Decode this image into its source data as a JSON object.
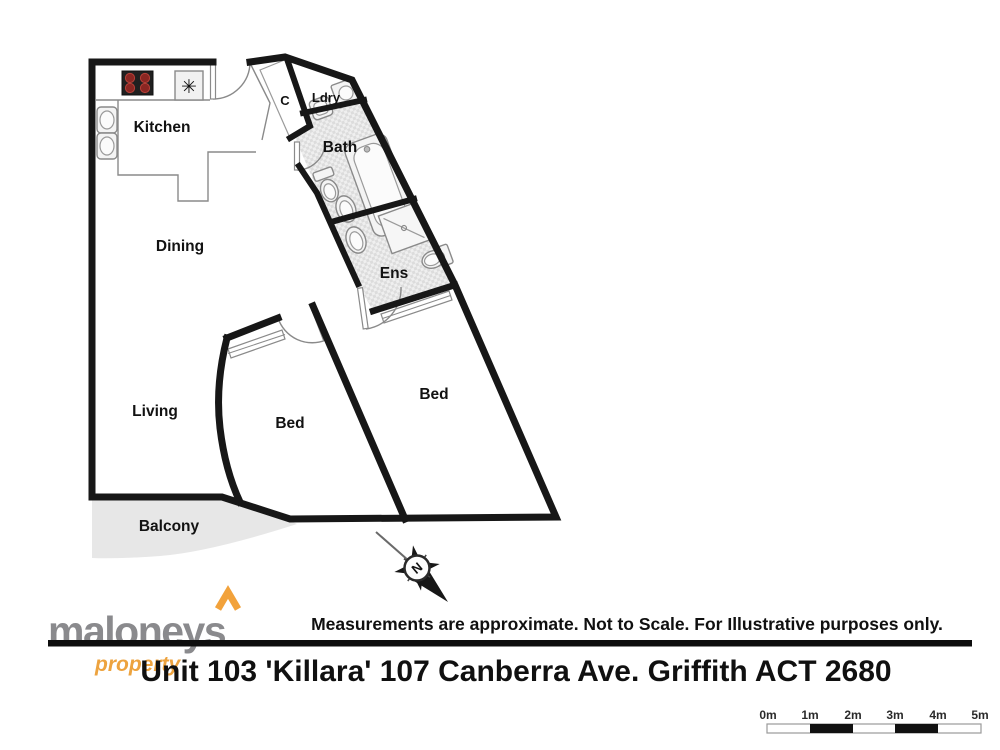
{
  "plan": {
    "rooms": {
      "kitchen": "Kitchen",
      "dining": "Dining",
      "living": "Living",
      "balcony": "Balcony",
      "bed1": "Bed",
      "bed2": "Bed",
      "bath": "Bath",
      "ens": "Ens",
      "laundry": "Ldry",
      "closet": "C"
    },
    "compass_label": "N",
    "freezer_symbol": "✳"
  },
  "footer": {
    "disclaimer": "Measurements are approximate. Not to Scale. For Illustrative purposes only.",
    "address": "Unit 103 'Killara' 107 Canberra Ave. Griffith ACT 2680"
  },
  "logo": {
    "name": "maloneys",
    "tagline": "property"
  },
  "scale_bar": {
    "labels": [
      "0m",
      "1m",
      "2m",
      "3m",
      "4m",
      "5m"
    ]
  },
  "colors": {
    "wall": "#171717",
    "balcony_fill": "#e7e7e7",
    "tile_fill": "#dcdcdc",
    "logo_gray": "#8a8a8d",
    "logo_orange": "#eda33f",
    "stove_burner": "#8a2622"
  }
}
